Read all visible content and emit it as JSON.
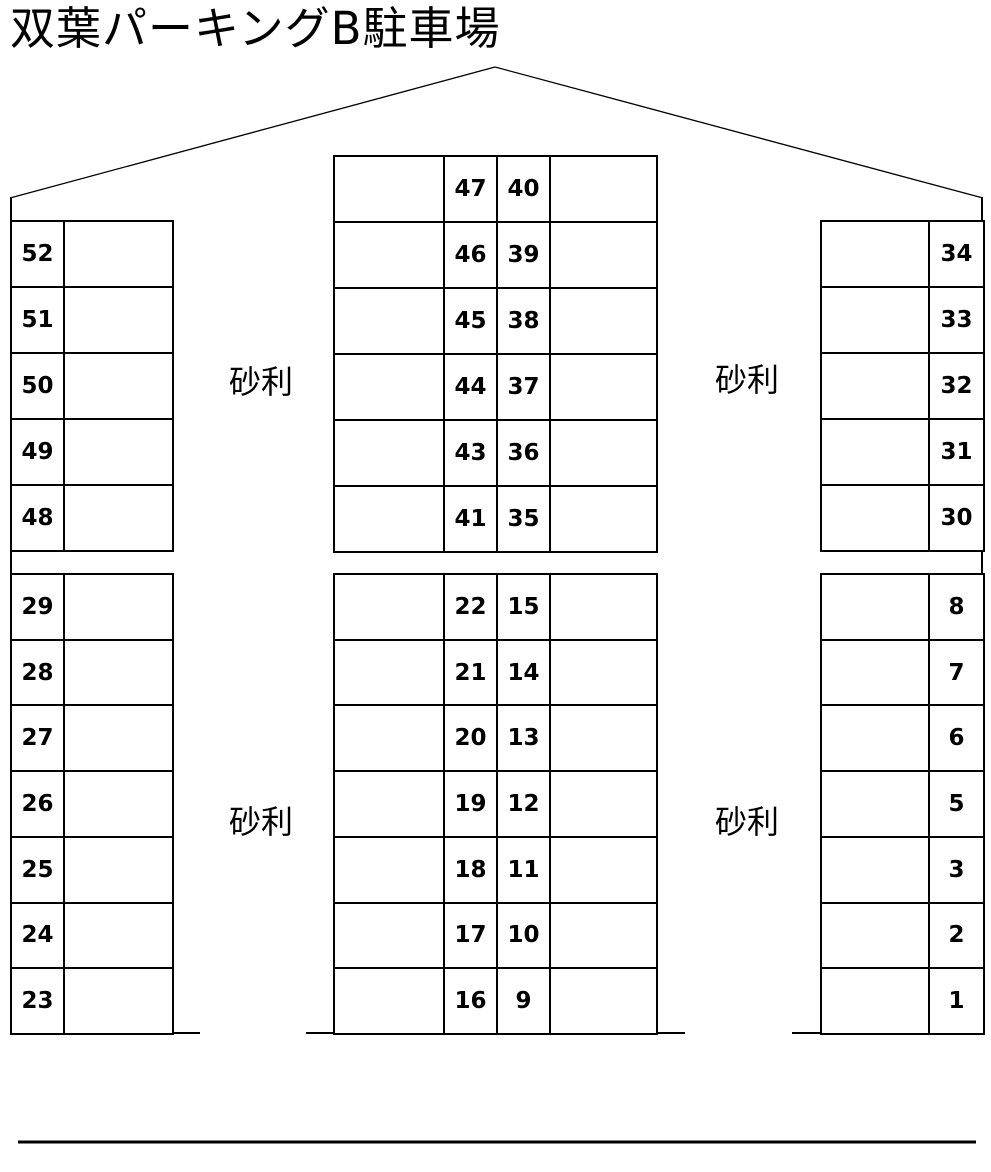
{
  "title": "双葉パーキングB駐車場",
  "colors": {
    "line": "#000000",
    "background": "#ffffff",
    "text": "#000000"
  },
  "gravel_labels": {
    "top_left": "砂利",
    "top_right": "砂利",
    "bottom_left": "砂利",
    "bottom_right": "砂利"
  },
  "lot": {
    "left_top": {
      "rows": [
        "52",
        "51",
        "50",
        "49",
        "48"
      ]
    },
    "left_bottom": {
      "rows": [
        "29",
        "28",
        "27",
        "26",
        "25",
        "24",
        "23"
      ]
    },
    "center_top": {
      "rows": [
        [
          "47",
          "40"
        ],
        [
          "46",
          "39"
        ],
        [
          "45",
          "38"
        ],
        [
          "44",
          "37"
        ],
        [
          "43",
          "36"
        ],
        [
          "41",
          "35"
        ]
      ]
    },
    "center_bottom": {
      "rows": [
        [
          "22",
          "15"
        ],
        [
          "21",
          "14"
        ],
        [
          "20",
          "13"
        ],
        [
          "19",
          "12"
        ],
        [
          "18",
          "11"
        ],
        [
          "17",
          "10"
        ],
        [
          "16",
          "9"
        ]
      ]
    },
    "right_top": {
      "rows": [
        "34",
        "33",
        "32",
        "31",
        "30"
      ]
    },
    "right_bottom": {
      "rows": [
        "8",
        "7",
        "6",
        "5",
        "3",
        "2",
        "1"
      ]
    }
  }
}
